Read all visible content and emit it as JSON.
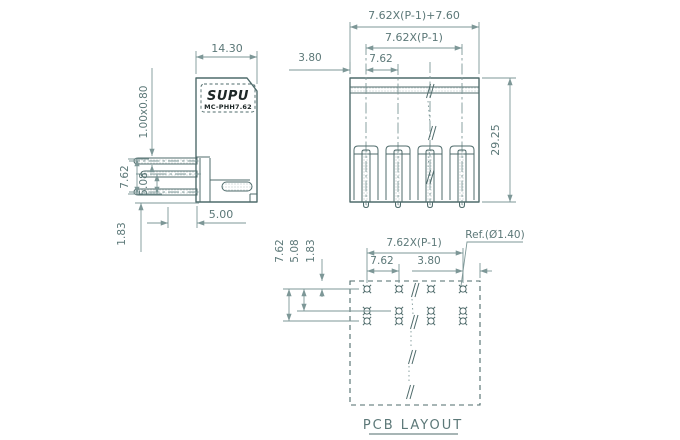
{
  "drawing": {
    "colors": {
      "line": "#4f6b6b",
      "dim": "#7d9797",
      "text": "#5c7878",
      "logo": "#1d2727",
      "fill_dots": "#93a9a9"
    },
    "side_view": {
      "logo_text": "SUPU",
      "model_text": "MC-PHH7.62",
      "dim_width": "14.30",
      "dim_pin_section": "1.00x0.80",
      "dim_pin_span": "7.62",
      "dim_pin_pitch": "5.08",
      "dim_pin_offset": "1.83",
      "dim_pin_length": "5.00"
    },
    "front_view": {
      "dim_total_width": "7.62X(P-1)+7.60",
      "dim_pin_span": "7.62X(P-1)",
      "dim_pitch": "7.62",
      "dim_edge_offset": "3.80",
      "dim_height": "29.25"
    },
    "pcb_layout": {
      "title": "PCB LAYOUT",
      "dim_row_span": "7.62",
      "dim_row_pitch": "5.08",
      "dim_edge_offset": "1.83",
      "dim_pin_span": "7.62X(P-1)",
      "dim_pitch": "7.62",
      "dim_edge_gap": "3.80",
      "hole_ref": "Ref.(Ø1.40)"
    }
  }
}
